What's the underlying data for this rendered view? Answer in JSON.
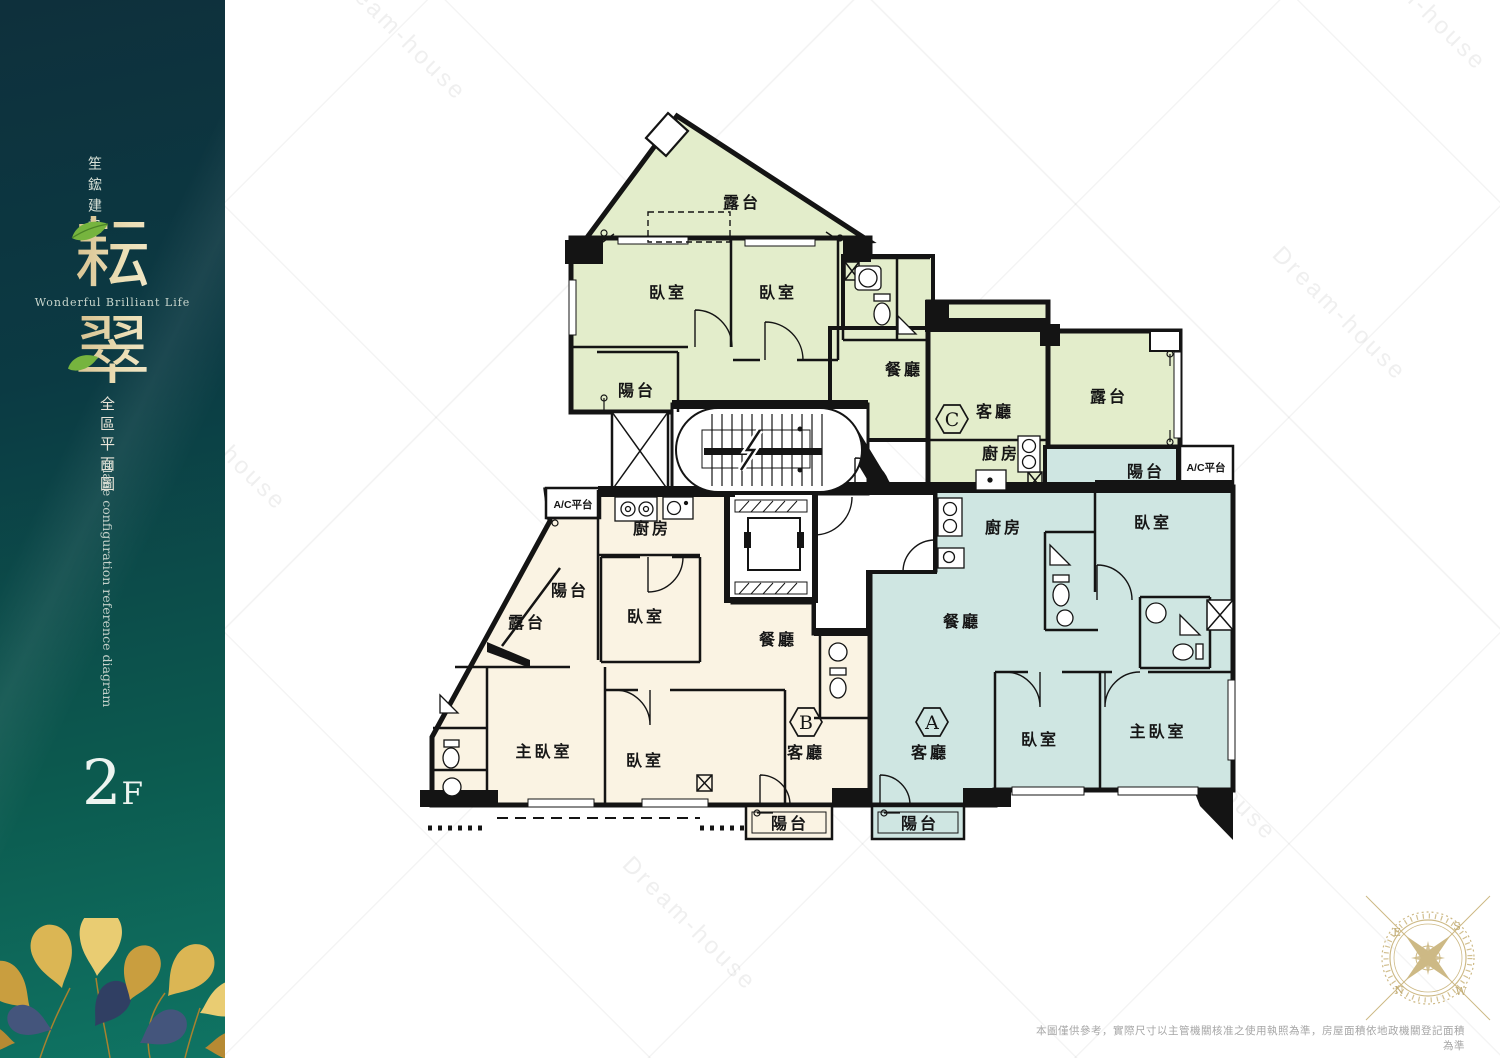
{
  "sidebar": {
    "company": "笙鋐建設",
    "title_char_1": "耘",
    "title_char_2": "翠",
    "tagline": "Wonderful Brilliant Life",
    "subtitle_zh": "全區平面圖",
    "subtitle_en": "Plane configuration reference diagram",
    "floor_number": "2",
    "floor_suffix": "F"
  },
  "labels": {
    "terrace": "露台",
    "balcony": "陽台",
    "bedroom": "臥室",
    "master_bedroom": "主臥室",
    "dining": "餐廳",
    "living": "客廳",
    "kitchen": "廚房",
    "ac_platform": "A/C平台"
  },
  "units": {
    "a": {
      "badge": "A",
      "color": "#cfe6e2"
    },
    "b": {
      "badge": "B",
      "color": "#faf3e3"
    },
    "c": {
      "badge": "C",
      "color": "#e3edcb"
    }
  },
  "compass": {
    "e": "E",
    "s": "S",
    "n": "N",
    "w": "W"
  },
  "watermark": "Dream-house",
  "disclaimer": "本圖僅供參考，實際尺寸以主管機關核准之使用執照為準，房屋面積依地政機關登記面積為準"
}
